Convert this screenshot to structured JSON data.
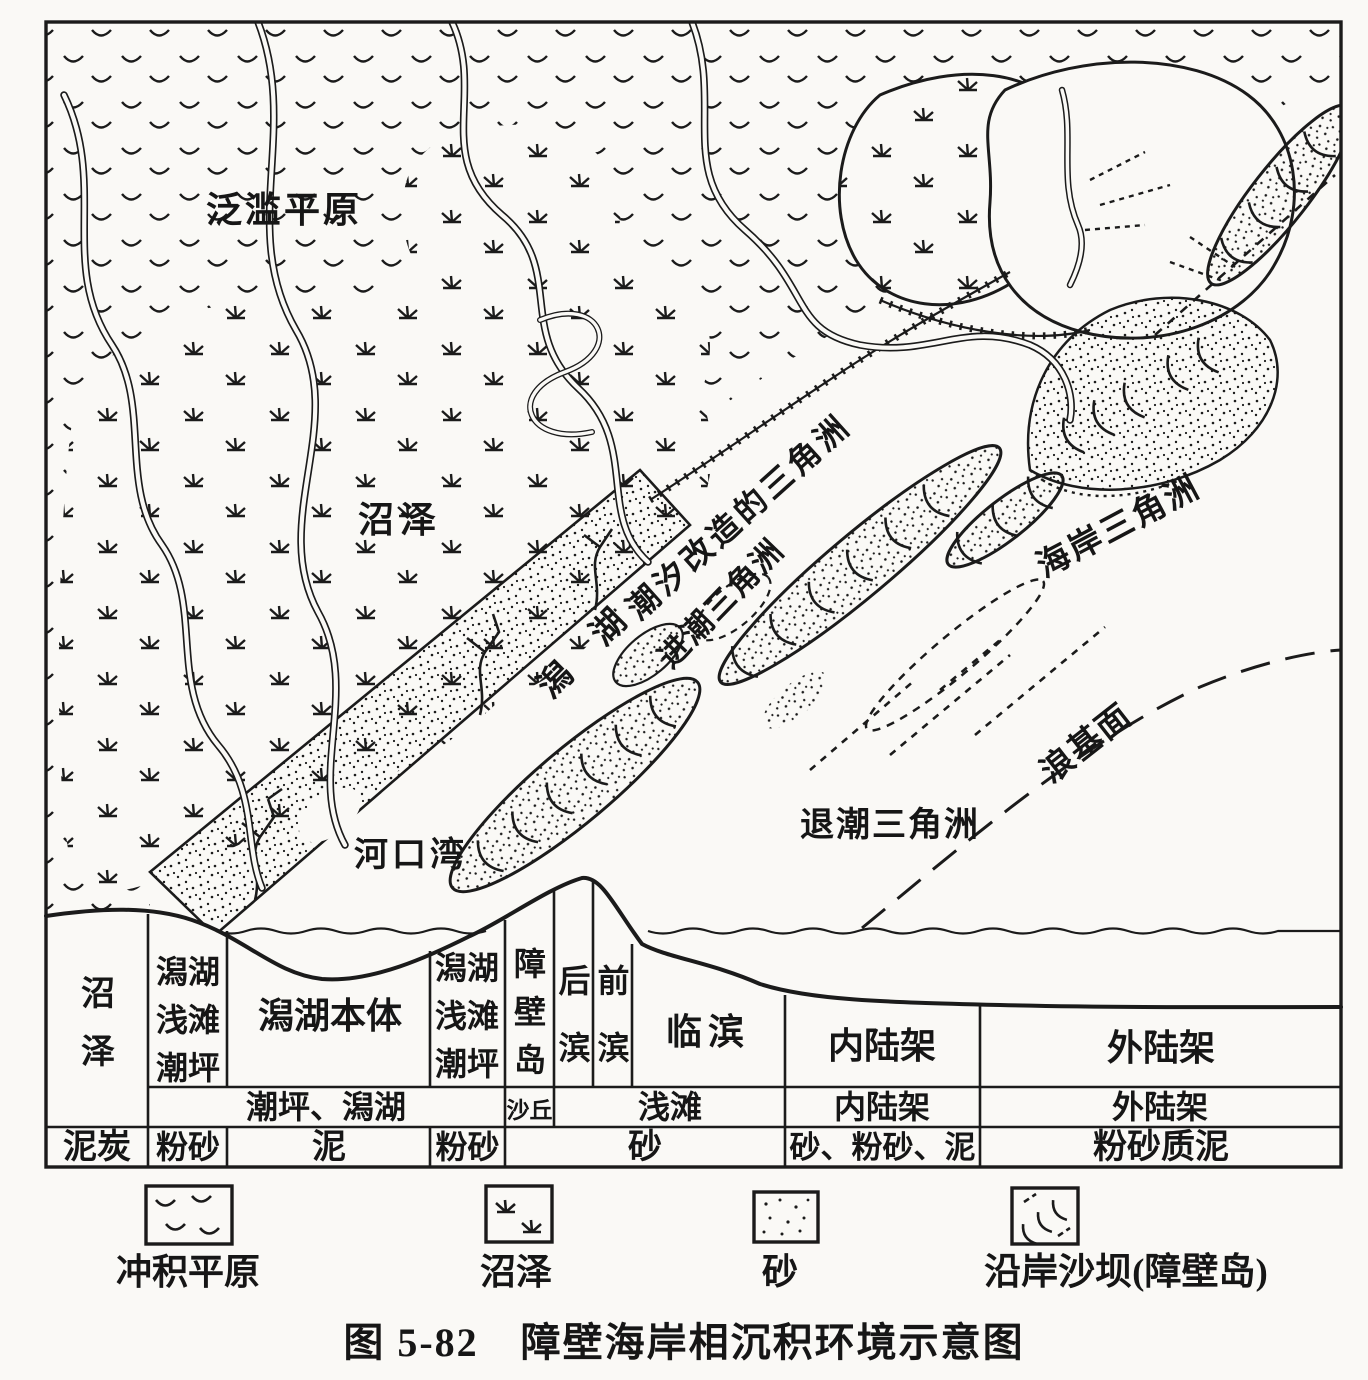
{
  "figure": {
    "caption": "图 5-82　障壁海岸相沉积环境示意图"
  },
  "map": {
    "flood_plain": "泛滥平原",
    "swamp": "沼泽",
    "lagoon": "潟 湖",
    "tide_modified_delta": "潮汐改造的三角洲",
    "flood_tidal_delta": "进潮三角洲",
    "coastal_delta": "海岸三角洲",
    "estuary": "河口湾",
    "ebb_tidal_delta": "退潮三角洲",
    "wave_base": "浪基面"
  },
  "section_table": {
    "environments": [
      "沼泽",
      "潟湖浅滩潮坪",
      "潟湖本体",
      "潟湖浅滩潮坪",
      "障壁岛",
      "后滨",
      "前滨",
      "临滨",
      "内陆架",
      "外陆架"
    ],
    "subenvironments": [
      "潮坪、潟湖",
      "沙丘",
      "浅滩",
      "内陆架",
      "外陆架"
    ],
    "sediments": [
      "泥炭",
      "粉砂",
      "泥",
      "粉砂",
      "砂",
      "砂、粉砂、泥",
      "粉砂质泥"
    ]
  },
  "legend": {
    "items": [
      {
        "symbol": "alluvial-plain-pattern",
        "label": "冲积平原"
      },
      {
        "symbol": "swamp-pattern",
        "label": "沼泽"
      },
      {
        "symbol": "sand-pattern",
        "label": "砂"
      },
      {
        "symbol": "shore-bar-pattern",
        "label": "沿岸沙坝(障壁岛)"
      }
    ]
  }
}
